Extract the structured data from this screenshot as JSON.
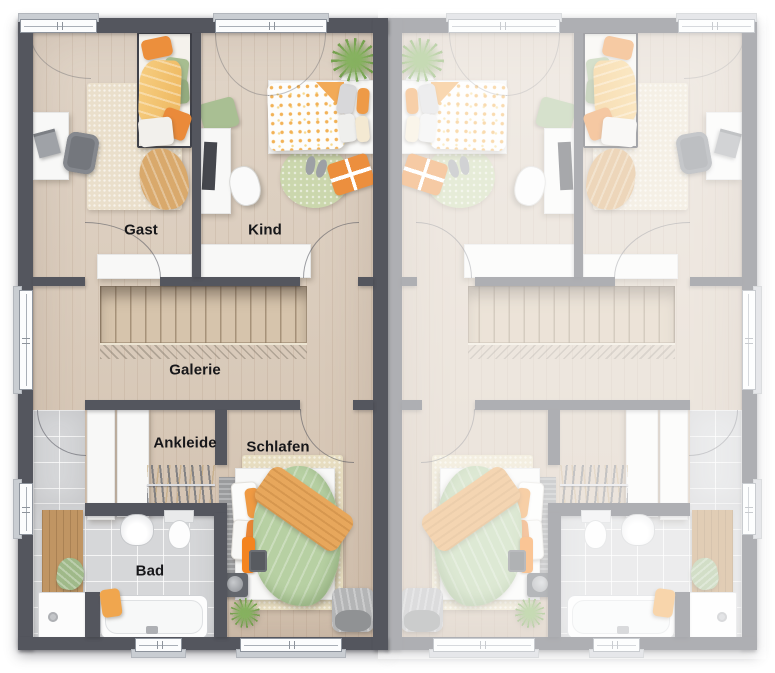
{
  "floor_plan": {
    "rooms": {
      "gast": {
        "label": "Gast"
      },
      "kind": {
        "label": "Kind"
      },
      "galerie": {
        "label": "Galerie"
      },
      "ankleide": {
        "label": "Ankleide"
      },
      "schlafen": {
        "label": "Schlafen"
      },
      "bad": {
        "label": "Bad"
      }
    },
    "colors": {
      "wall": "#54565e",
      "floor-wood": "#d8c9b8",
      "floor-tile": "#d6d7d9",
      "stair-wood": "#d6c4ac",
      "rug-cream": "#eadfcb",
      "rug-beige": "#e7ddc0",
      "rug-green": "#cbd7ad",
      "furniture-white": "#f8f8f7",
      "accent-orange": "#ec9040",
      "accent-yellow": "#f3c97b",
      "accent-green": "#a9bf93",
      "duvet-sage": "#b7d0a3",
      "plant-green": "#6f9c44",
      "window-frame": "#fbfcfd",
      "window-sill": "#c9cdd2",
      "fade-overlay": "rgba(255,255,255,0.53)"
    }
  }
}
